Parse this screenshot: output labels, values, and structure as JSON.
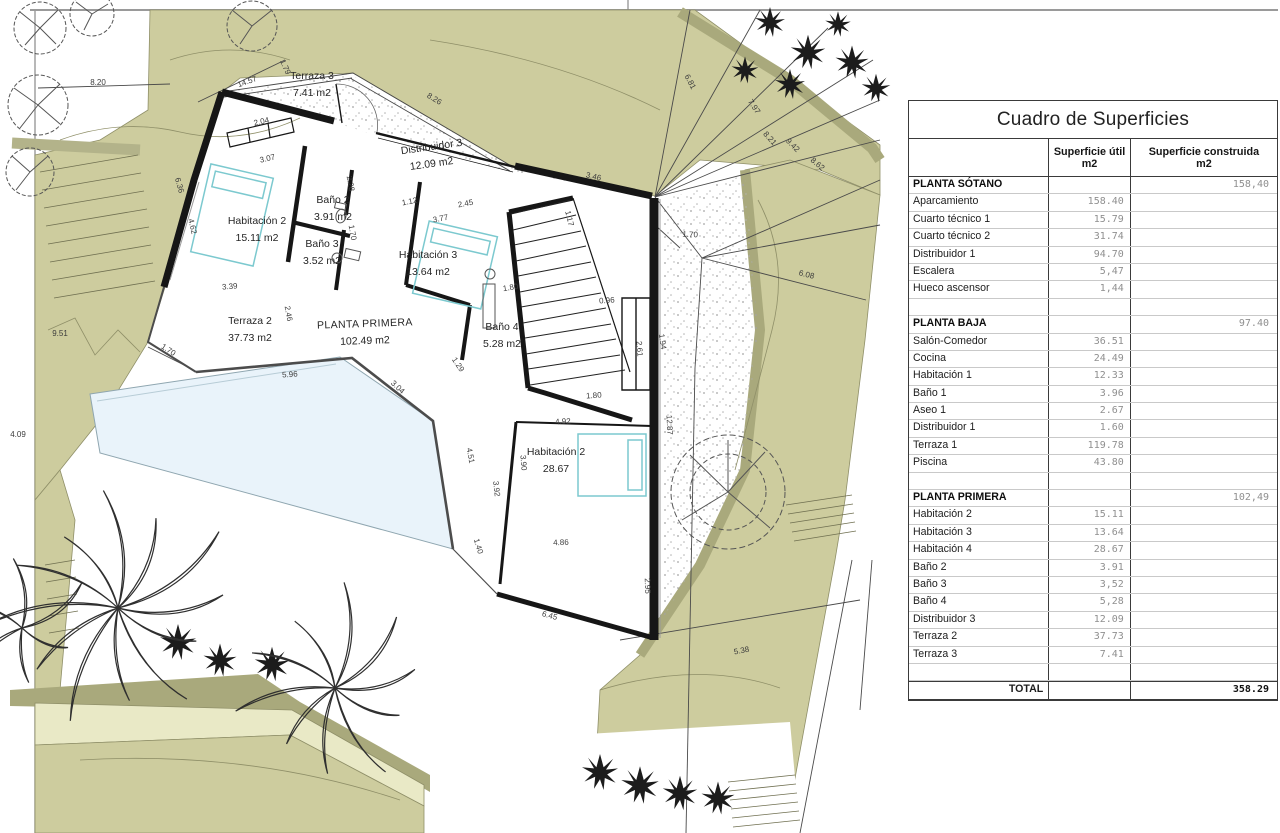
{
  "table": {
    "title": "Cuadro de Superficies",
    "col_util_line1": "Superficie útil",
    "col_util_line2": "m2",
    "col_built_line1": "Superficie construida",
    "col_built_line2": "m2",
    "rows": [
      {
        "k": "sec",
        "l": "PLANTA SÓTANO",
        "u": "",
        "b": "158,40"
      },
      {
        "k": "r",
        "l": "Aparcamiento",
        "u": "158.40",
        "b": ""
      },
      {
        "k": "r",
        "l": "Cuarto técnico 1",
        "u": "15.79",
        "b": ""
      },
      {
        "k": "r",
        "l": "Cuarto técnico 2",
        "u": "31.74",
        "b": ""
      },
      {
        "k": "r",
        "l": "Distribuidor 1",
        "u": "94.70",
        "b": ""
      },
      {
        "k": "r",
        "l": "Escalera",
        "u": "5,47",
        "b": ""
      },
      {
        "k": "r",
        "l": "Hueco ascensor",
        "u": "1,44",
        "b": ""
      },
      {
        "k": "sp",
        "l": "",
        "u": "",
        "b": ""
      },
      {
        "k": "sec",
        "l": "PLANTA BAJA",
        "u": "",
        "b": "97.40"
      },
      {
        "k": "r",
        "l": "Salón-Comedor",
        "u": "36.51",
        "b": ""
      },
      {
        "k": "r",
        "l": "Cocina",
        "u": "24.49",
        "b": ""
      },
      {
        "k": "r",
        "l": "Habitación 1",
        "u": "12.33",
        "b": ""
      },
      {
        "k": "r",
        "l": "Baño 1",
        "u": "3.96",
        "b": ""
      },
      {
        "k": "r",
        "l": "Aseo 1",
        "u": "2.67",
        "b": ""
      },
      {
        "k": "r",
        "l": "Distribuidor 1",
        "u": "1.60",
        "b": ""
      },
      {
        "k": "r",
        "l": "Terraza 1",
        "u": "119.78",
        "b": ""
      },
      {
        "k": "r",
        "l": "Piscina",
        "u": "43.80",
        "b": ""
      },
      {
        "k": "sp",
        "l": "",
        "u": "",
        "b": ""
      },
      {
        "k": "sec",
        "l": "PLANTA PRIMERA",
        "u": "",
        "b": "102,49"
      },
      {
        "k": "r",
        "l": "Habitación 2",
        "u": "15.11",
        "b": ""
      },
      {
        "k": "r",
        "l": "Habitación 3",
        "u": "13.64",
        "b": ""
      },
      {
        "k": "r",
        "l": "Habitación 4",
        "u": "28.67",
        "b": ""
      },
      {
        "k": "r",
        "l": "Baño 2",
        "u": "3.91",
        "b": ""
      },
      {
        "k": "r",
        "l": "Baño 3",
        "u": "3,52",
        "b": ""
      },
      {
        "k": "r",
        "l": "Baño 4",
        "u": "5,28",
        "b": ""
      },
      {
        "k": "r",
        "l": "Distribuidor 3",
        "u": "12.09",
        "b": ""
      },
      {
        "k": "r",
        "l": "Terraza 2",
        "u": "37.73",
        "b": ""
      },
      {
        "k": "r",
        "l": "Terraza 3",
        "u": "7.41",
        "b": ""
      },
      {
        "k": "sp",
        "l": "",
        "u": "",
        "b": ""
      },
      {
        "k": "tot",
        "l": "TOTAL",
        "u": "",
        "b": "358.29"
      }
    ]
  },
  "plan": {
    "rooms": [
      {
        "name": "Terraza 3",
        "area": "7.41 m2",
        "x": 312,
        "y": 79,
        "rot": 0
      },
      {
        "name": "Distribuidor 3",
        "area": "12.09 m2",
        "x": 432,
        "y": 150,
        "rot": -8
      },
      {
        "name": "Habitación 2",
        "area": "15.11 m2",
        "x": 257,
        "y": 224,
        "rot": 0
      },
      {
        "name": "Baño 2",
        "area": "3.91 m2",
        "x": 333,
        "y": 203,
        "rot": 0
      },
      {
        "name": "Baño 3",
        "area": "3.52 m2",
        "x": 322,
        "y": 247,
        "rot": 0
      },
      {
        "name": "Habitación 3",
        "area": "13.64 m2",
        "x": 428,
        "y": 258,
        "rot": 0
      },
      {
        "name": "Baño 4",
        "area": "5.28 m2",
        "x": 502,
        "y": 330,
        "rot": 0
      },
      {
        "name": "PLANTA PRIMERA",
        "area": "102.49 m2",
        "x": 365,
        "y": 327,
        "rot": -2,
        "caps": true
      },
      {
        "name": "Terraza 2",
        "area": "37.73 m2",
        "x": 250,
        "y": 324,
        "rot": 0
      },
      {
        "name": "Habitación 2",
        "area": "28.67",
        "x": 556,
        "y": 455,
        "rot": 0
      }
    ],
    "dimensions": [
      {
        "t": "8.20",
        "x": 98,
        "y": 85,
        "r": 0
      },
      {
        "t": "14.57",
        "x": 248,
        "y": 84,
        "r": -20
      },
      {
        "t": "1.79",
        "x": 283,
        "y": 68,
        "r": 66
      },
      {
        "t": "8.26",
        "x": 433,
        "y": 101,
        "r": 31
      },
      {
        "t": "6.81",
        "x": 688,
        "y": 83,
        "r": 62
      },
      {
        "t": "7.97",
        "x": 752,
        "y": 108,
        "r": 56
      },
      {
        "t": "8.21",
        "x": 768,
        "y": 140,
        "r": 48
      },
      {
        "t": "9.42",
        "x": 791,
        "y": 147,
        "r": 45
      },
      {
        "t": "8.62",
        "x": 816,
        "y": 166,
        "r": 40
      },
      {
        "t": "6.08",
        "x": 806,
        "y": 277,
        "r": 14
      },
      {
        "t": "1.70",
        "x": 690,
        "y": 237,
        "r": 3
      },
      {
        "t": "1.94",
        "x": 660,
        "y": 342,
        "r": 82
      },
      {
        "t": "12.87",
        "x": 667,
        "y": 425,
        "r": 87
      },
      {
        "t": "5.38",
        "x": 742,
        "y": 653,
        "r": -11
      },
      {
        "t": "6.45",
        "x": 549,
        "y": 618,
        "r": 15
      },
      {
        "t": "2.95",
        "x": 645,
        "y": 586,
        "r": 88
      },
      {
        "t": "4.86",
        "x": 561,
        "y": 545,
        "r": -2
      },
      {
        "t": "4.92",
        "x": 563,
        "y": 424,
        "r": -3
      },
      {
        "t": "3.90",
        "x": 521,
        "y": 463,
        "r": 85
      },
      {
        "t": "1.80",
        "x": 594,
        "y": 398,
        "r": -4
      },
      {
        "t": "2.61",
        "x": 637,
        "y": 349,
        "r": 85
      },
      {
        "t": "0.96",
        "x": 607,
        "y": 303,
        "r": -4
      },
      {
        "t": "1.80",
        "x": 511,
        "y": 290,
        "r": -9
      },
      {
        "t": "3.46",
        "x": 593,
        "y": 179,
        "r": 13
      },
      {
        "t": "1.17",
        "x": 567,
        "y": 219,
        "r": 76
      },
      {
        "t": "2.45",
        "x": 466,
        "y": 206,
        "r": -11
      },
      {
        "t": "3.77",
        "x": 441,
        "y": 221,
        "r": -11
      },
      {
        "t": "1.12",
        "x": 410,
        "y": 204,
        "r": -11
      },
      {
        "t": "2.28",
        "x": 348,
        "y": 184,
        "r": 80
      },
      {
        "t": "1.70",
        "x": 350,
        "y": 233,
        "r": 80
      },
      {
        "t": "2.04",
        "x": 262,
        "y": 124,
        "r": -13
      },
      {
        "t": "3.07",
        "x": 268,
        "y": 161,
        "r": -13
      },
      {
        "t": "4.62",
        "x": 190,
        "y": 227,
        "r": 76
      },
      {
        "t": "6.36",
        "x": 177,
        "y": 186,
        "r": 74
      },
      {
        "t": "3.39",
        "x": 230,
        "y": 289,
        "r": -5
      },
      {
        "t": "2.46",
        "x": 286,
        "y": 314,
        "r": 80
      },
      {
        "t": "5.96",
        "x": 290,
        "y": 377,
        "r": -4
      },
      {
        "t": "1.70",
        "x": 167,
        "y": 352,
        "r": 33
      },
      {
        "t": "3.04",
        "x": 396,
        "y": 389,
        "r": 44
      },
      {
        "t": "1.29",
        "x": 456,
        "y": 366,
        "r": 56
      },
      {
        "t": "4.51",
        "x": 468,
        "y": 456,
        "r": 79
      },
      {
        "t": "3.92",
        "x": 494,
        "y": 489,
        "r": 84
      },
      {
        "t": "1.40",
        "x": 476,
        "y": 547,
        "r": 73
      },
      {
        "t": "9.51",
        "x": 60,
        "y": 336,
        "r": 0
      },
      {
        "t": "4.09",
        "x": 18,
        "y": 437,
        "r": 0
      }
    ]
  },
  "colors": {
    "olive": "#cdcc9e",
    "olive_dark": "#a9a97c",
    "pale_band": "#e9e9c6",
    "pool": "#e9f3fa",
    "bed_outline": "#7cc9cf",
    "wall": "#161616"
  }
}
